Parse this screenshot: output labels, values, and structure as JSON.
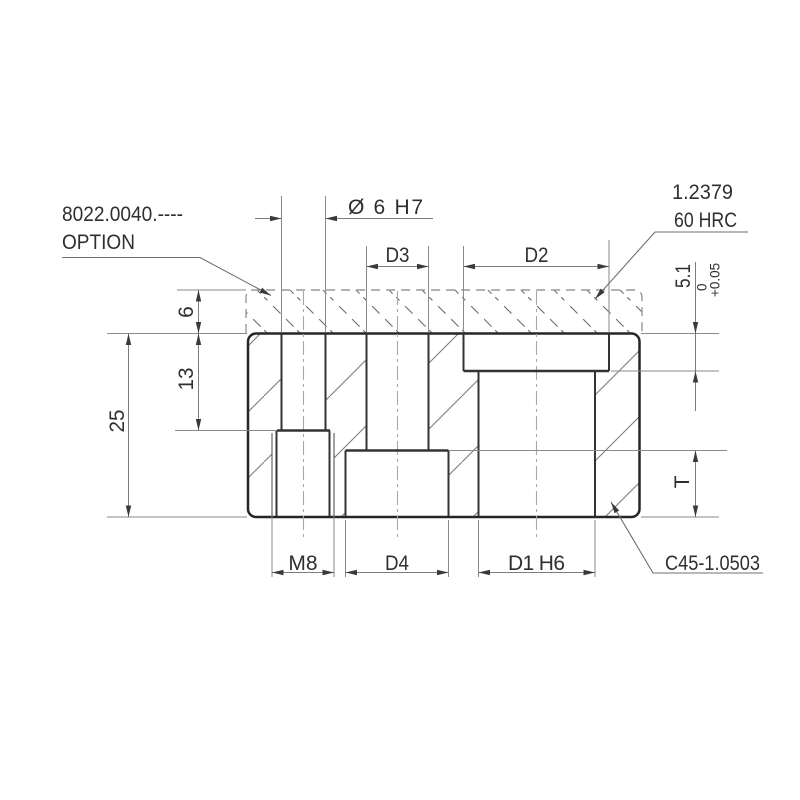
{
  "drawing": {
    "callouts": {
      "part_number": "8022.0040.----",
      "option": "OPTION",
      "steel_grade": "1.2379",
      "hardness": "60 HRC",
      "material": "C45-1.0503"
    },
    "dimensions": {
      "top_hole": "Ø 6 H7",
      "d3": "D3",
      "d2": "D2",
      "depth": "5.1",
      "tol_upper": "0",
      "tol_lower": "+0.05",
      "h6": "6",
      "h13": "13",
      "h25": "25",
      "t": "T",
      "m8": "M8",
      "d4": "D4",
      "d1": "D1 H6"
    },
    "colors": {
      "outline": "#262626",
      "hole_line": "#333333",
      "thin_line": "#7d7d7d",
      "centerline": "#a8a8a8",
      "dashed_zone": "#999999",
      "text": "#2f2f2f",
      "background": "#ffffff"
    }
  }
}
